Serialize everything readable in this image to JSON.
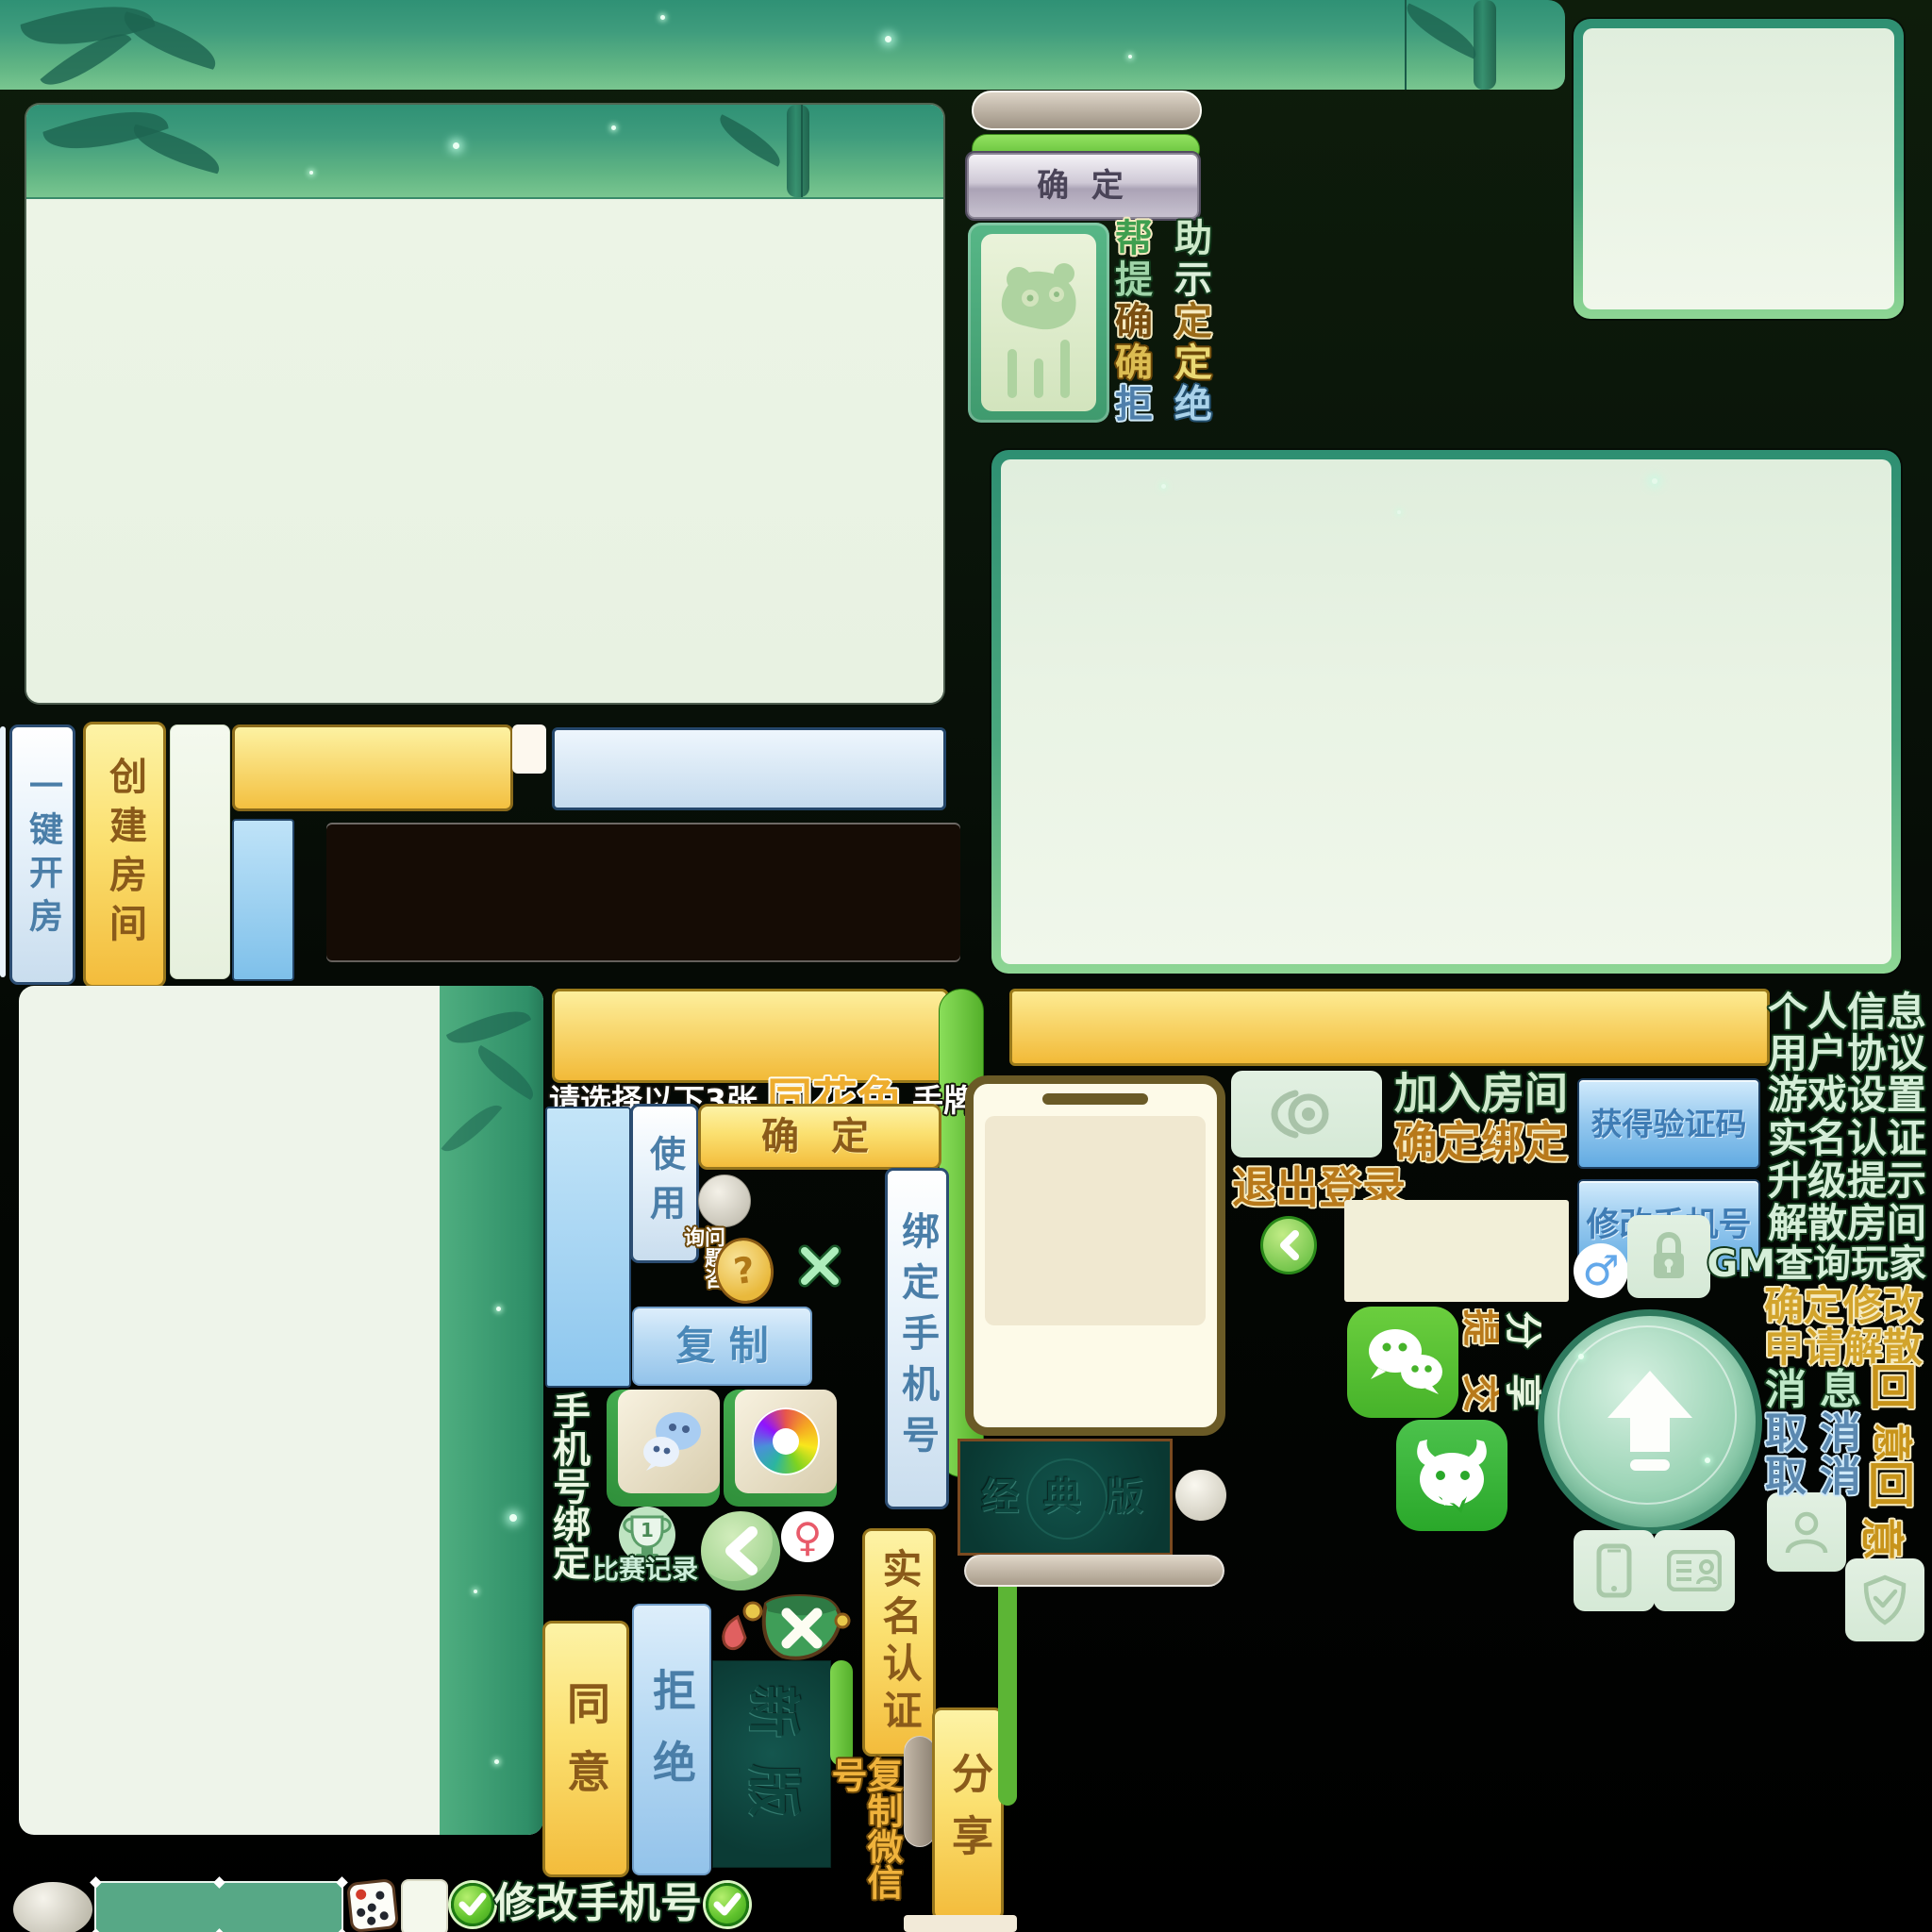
{
  "t": {
    "confirm_grey": "确 定",
    "pairs": [
      {
        "a": "帮",
        "b": "助"
      },
      {
        "a": "提",
        "b": "示"
      },
      {
        "a": "确",
        "b": "定"
      },
      {
        "a": "确",
        "b": "定"
      },
      {
        "a": "拒",
        "b": "绝"
      }
    ],
    "one_key": "一键开房",
    "create_room": "创建房间",
    "prompt_pre": "请选择以下3张",
    "prompt_hi": "同花色",
    "prompt_post": "手牌",
    "use": "使用",
    "confirm_yellow": "确 定",
    "question_consult": "问题咨询",
    "question_mark": "?",
    "copy": "复 制",
    "bind_phone_btn": "绑定手机号",
    "phone_bind_label": "手机号绑定",
    "trophy_num": "1",
    "match_record": "比赛记录",
    "female": "♀",
    "male": "♂",
    "agree": "同意",
    "refuse": "拒绝",
    "new_version": "新版",
    "realname_auth": "实名认证",
    "copy_wechat_id": "复制微信号",
    "share": "分享",
    "classic_version": "经 典 版",
    "join_room": "加入房间",
    "confirm_bind": "确定绑定",
    "logout": "退出登录",
    "get_verify_code": "获得验证码",
    "modify_phone": "修改手机号",
    "submit": "提交",
    "menu": [
      "个人信息",
      "用户协议",
      "游戏设置",
      "实名认证",
      "升级提示",
      "解散房间",
      "GM查询玩家"
    ],
    "confirm_modify": "确定修改",
    "apply_dissolve": "申请解散",
    "msg_c1": "消",
    "msg_c2": "息",
    "recall": "回",
    "cancel_c1": "取",
    "cancel_c2": "消",
    "agree_rot": "意"
  },
  "colors": {
    "accent_yellow": "#f3bc3c",
    "accent_green": "#5cb535",
    "teal_border": "#2e8f72",
    "blue_button": "#93c3ea",
    "gold_text": "#b8791a",
    "mint_text": "#d5eed8",
    "dark_bg": "#000000"
  },
  "icons": [
    "panda-tile-icon",
    "wechat-icon",
    "aperture-camera-icon",
    "trophy-icon",
    "back-chevron-icon",
    "female-icon",
    "male-icon",
    "question-coin-icon",
    "close-x-icon",
    "dice-cup-icon",
    "dice-icon",
    "check-icon",
    "replay-camera-icon",
    "lock-icon",
    "bull-chat-icon",
    "upload-arrow-icon",
    "smartphone-icon",
    "id-card-icon",
    "person-icon",
    "shield-check-icon"
  ]
}
